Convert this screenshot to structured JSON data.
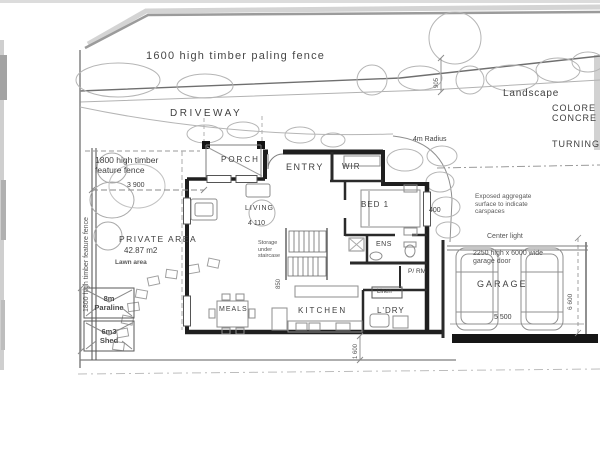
{
  "document": {
    "type": "scanned residential site / floor plan"
  },
  "colors": {
    "paper": "#ffffff",
    "ink": "#3f3f3f",
    "wall": "#1f1f1f",
    "faint_line": "#a8a8a8"
  },
  "labels": {
    "site": {
      "paling_fence": "1600 high timber paling fence",
      "driveway": "DRIVEWAY",
      "landscape": "Landscape",
      "colored_line1": "COLORE",
      "colored_line2": "CONCRE",
      "turning": "TURNING",
      "radius": "4m Radius",
      "feature_fence_h": "1800 high timber\nfeature fence",
      "feature_fence_v": "1800 high timber feature fence",
      "private_area": "PRIVATE AREA",
      "private_area_size": "42.87 m2",
      "lawn": "Lawn area",
      "paraline": "8m\nParaline",
      "shed": "6m3\nShed",
      "exposed_aggregate": "Exposed aggregate\nsurface to indicate\ncarspaces",
      "center_light": "Center light",
      "garage_door": "2250 high x 6000 wide\ngarage door"
    },
    "rooms": {
      "porch": "PORCH",
      "entry": "ENTRY",
      "wir": "WIR",
      "bed1": "BED 1",
      "living": "LIVING",
      "storage": "Storage\nunder\nstaircase",
      "ens": "ENS",
      "powder": "P/ RM",
      "linen": "Linen",
      "meals": "MEALS",
      "kitchen": "KITCHEN",
      "laundry": "L'DRY",
      "garage": "GARAGE"
    },
    "dimensions": {
      "front_setback": "3 900",
      "living_width": "4 110",
      "d400": "400",
      "d905": "905",
      "stair": "850",
      "d1600": "1 600",
      "garage_width": "5 500",
      "garage_depth": "6 600"
    }
  }
}
